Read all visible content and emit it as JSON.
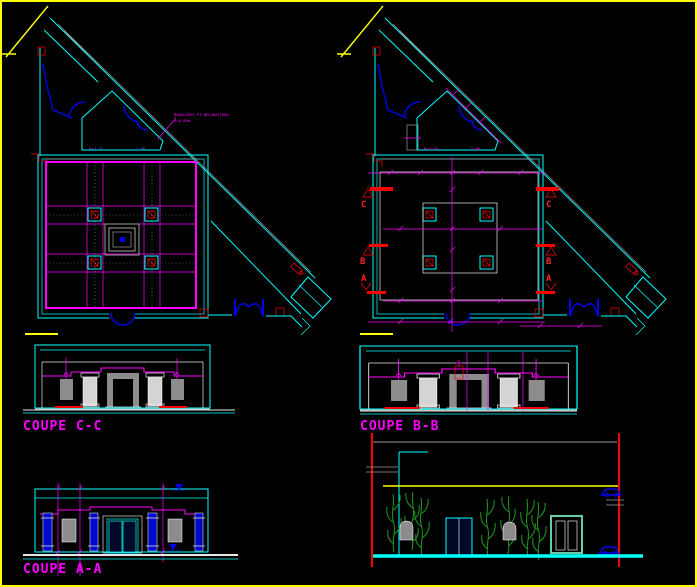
{
  "labels": {
    "section_cc": "COUPE C-C",
    "section_bb": "COUPE B-B",
    "section_aa": "COUPE A-A"
  },
  "markers": {
    "c": "C",
    "b": "B",
    "a": "A"
  },
  "annotation": {
    "line1": "MODELURES ET DECORATIONS",
    "line2": "h=0.80m"
  },
  "dimensions": {
    "entrance_height": "H=3.10",
    "entrance_width": "2.80"
  },
  "colors": {
    "background": "#000000",
    "border": "#ffff00",
    "walls": "#00ffff",
    "dimension_lines": "#ff00ff",
    "doors": "#0000ee",
    "section_markers": "#ff0000",
    "structure": "#9a9a9a",
    "vegetation": "#1f9a1f",
    "gate": "#66cdaa"
  }
}
